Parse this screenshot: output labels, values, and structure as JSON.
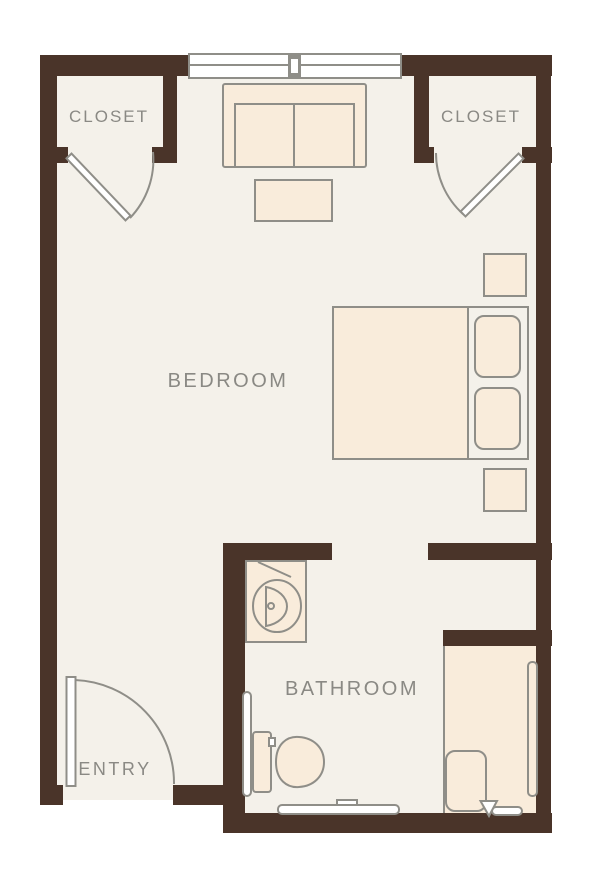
{
  "diagram": {
    "type": "floor-plan",
    "rooms": {
      "bedroom": {
        "label": "BEDROOM"
      },
      "bathroom": {
        "label": "BATHROOM"
      },
      "entry": {
        "label": "ENTRY"
      },
      "closet_left": {
        "label": "CLOSET"
      },
      "closet_right": {
        "label": "CLOSET"
      }
    },
    "fixtures": [
      "window",
      "loveseat-sofa",
      "coffee-table",
      "bed",
      "pillow",
      "pillow",
      "nightstand-upper",
      "nightstand-lower",
      "closet-door-left",
      "closet-door-right",
      "entry-door",
      "vanity-sink",
      "vanity-mirror",
      "toilet",
      "toilet-grab-bar",
      "towel-bar",
      "shower",
      "shower-bench",
      "shower-grab-bar",
      "shower-head"
    ]
  },
  "colors": {
    "wall": "#4a3429",
    "floor": "#f4f1ea",
    "fixture_fill": "#f9ecdb",
    "outline": "#8f8e88",
    "label_text": "#8a8984",
    "window_fill": "#ffffff",
    "background": "#ffffff"
  }
}
